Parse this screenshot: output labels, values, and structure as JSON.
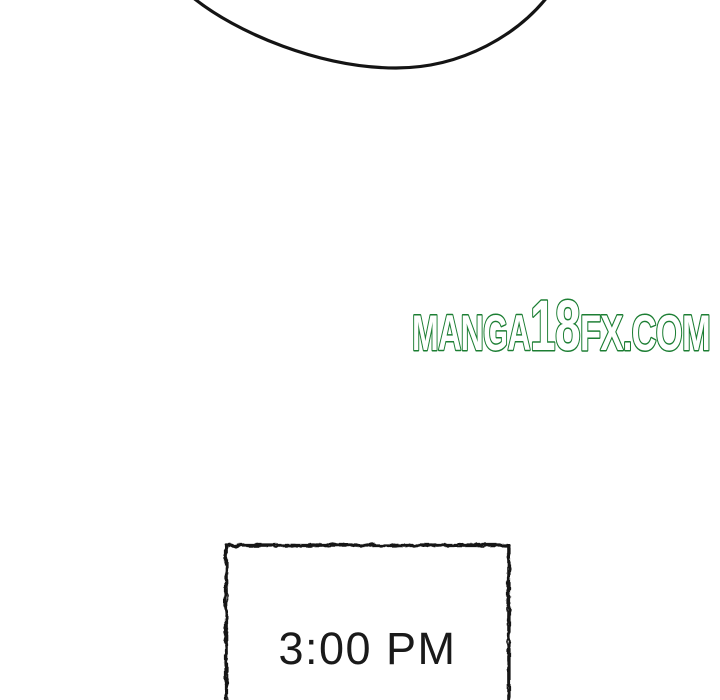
{
  "page": {
    "background_color": "#ffffff"
  },
  "speech_bubble": {
    "stroke_color": "#141414"
  },
  "watermark": {
    "prefix": "MANGA",
    "number": "18",
    "suffix": "FX.COM",
    "full_text": "MANGA18FX.COM",
    "outline_color": "#1c7e33",
    "fill_color": "#ffffff"
  },
  "time_panel": {
    "time_label": "3:00 PM",
    "border_color": "#131313",
    "text_color": "#1a1a1a"
  }
}
